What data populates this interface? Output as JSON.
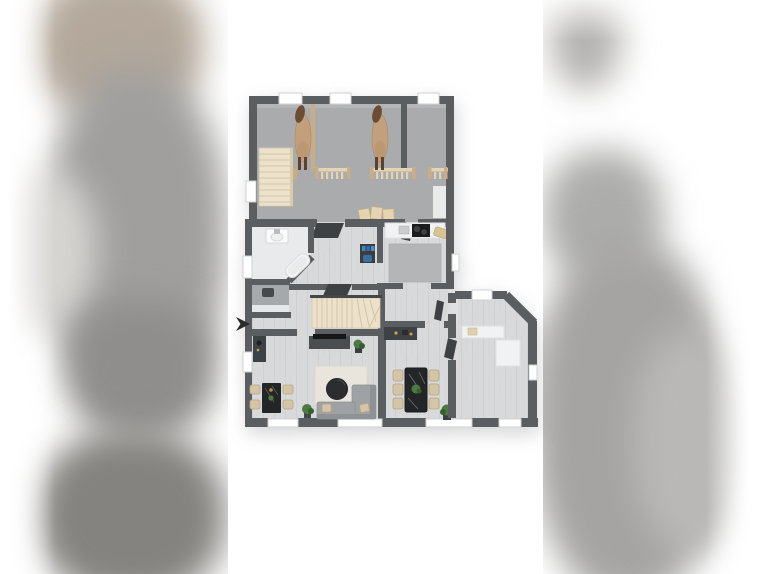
{
  "scene": {
    "kind": "3d-floor-plan-rendering",
    "view": "top-down birds-eye",
    "background": "white with blurred copies of the plan letterboxed left and right",
    "visible_text": "none"
  },
  "palette": {
    "page_bg": "#ffffff",
    "wall": "#5b5e61",
    "window_frame": "#cfd1d3",
    "door": "#3e4144",
    "stable_floor": "#a9abad",
    "house_floor": "#d8d9db",
    "bath_floor": "#e9eaeb",
    "wc_floor": "#a6a9ab",
    "kitchen_rug": "#b3b5b7",
    "counter": "#f1f2f3",
    "wood": "#e4d4b2",
    "wood_dark": "#c9ae85",
    "stair": "#ece2cb",
    "stair_line": "#d2c4a4",
    "furniture_dark": "#3f4245",
    "sofa": "#9fa2a5",
    "chair_beige": "#d4c5a7",
    "table_black": "#232527",
    "plant_green": "#4d7a43",
    "plant_dark": "#365e2f",
    "horse_body": "#c2a07c",
    "horse_dark": "#6e4c33",
    "band_taupe": "#b3a89b",
    "band_gray": "#a09f9e",
    "band_dark": "#85837f",
    "band_light": "#d6d4d1",
    "cursor_color": "#27292b"
  },
  "plan": {
    "upper_section": {
      "label": "stable with horse stalls",
      "horses": 2,
      "stalls": 3,
      "feed_fences": 3,
      "hay_bales": 3,
      "staircase": "straight run, left side",
      "windows_top": 3,
      "windows_left": 1
    },
    "lower_section": {
      "label": "residential ground floor",
      "rooms": {
        "bathroom": [
          "sink vanity",
          "bathtub angled",
          "separate wc with toilet"
        ],
        "hallway": [
          "interior doors",
          "blue utility desk"
        ],
        "kitchen": [
          "white counter",
          "black cooktop",
          "sink",
          "basket",
          "gray rug"
        ],
        "staircase": "winder stairs turning right",
        "living_room": [
          "wall shelf with lamp",
          "tv sideboard",
          "tv",
          "plant",
          "area rug",
          "round coffee table",
          "corner sofa with 2 cushions",
          "small dining table",
          "4 chairs",
          "floor plant"
        ],
        "dining_room": [
          "console with decor",
          "black stone dining table",
          "6 beige chairs",
          "table plant",
          "floor plant"
        ],
        "annex_wing": [
          "l-shaped white counter",
          "angled corner wall",
          "windows"
        ]
      },
      "windows_bottom": 4
    },
    "cursor_arrow": {
      "glyph": "right-pointing solid arrow",
      "position": "left of plan, mid height"
    }
  }
}
